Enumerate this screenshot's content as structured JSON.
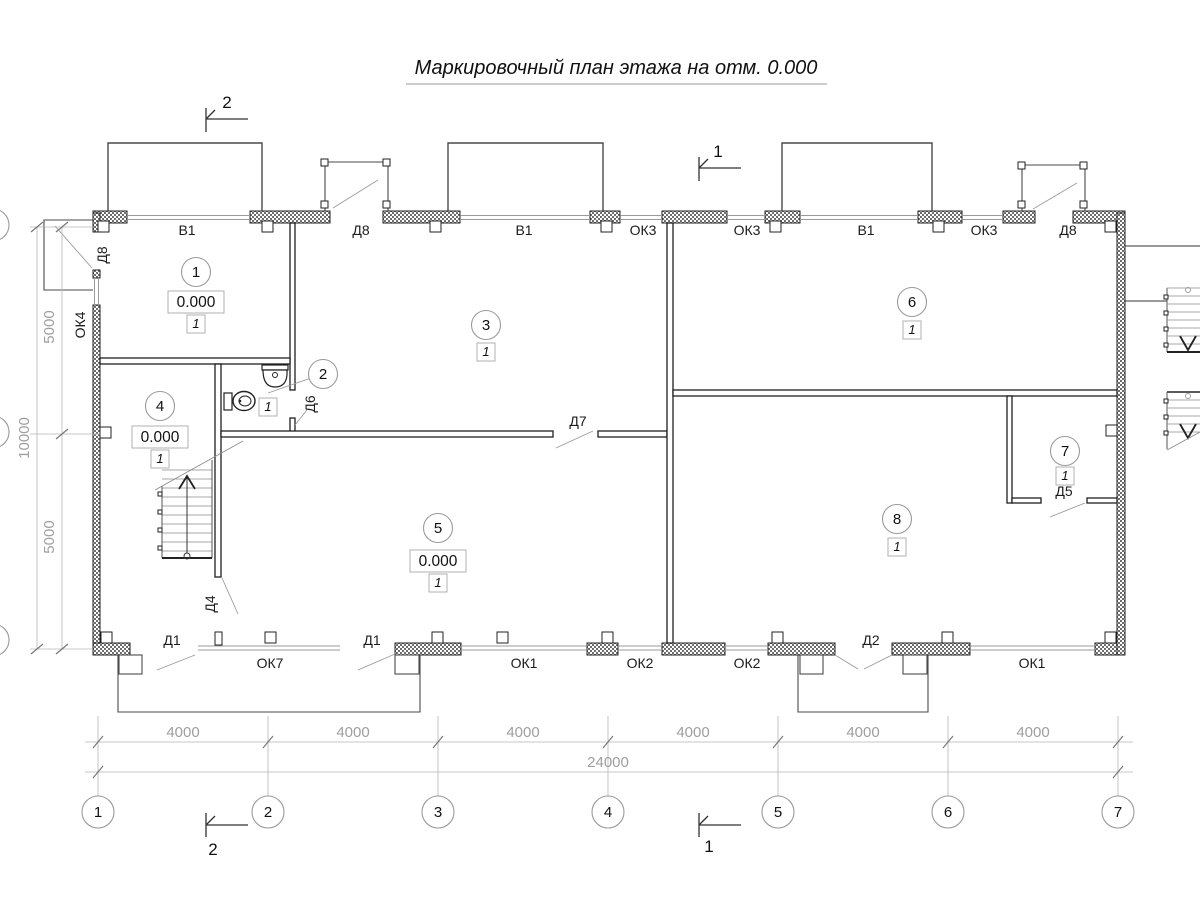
{
  "title": "Маркировочный план этажа на отм. 0.000",
  "section_marks": {
    "top_left": "2",
    "top_center": "1",
    "bottom_left": "2",
    "bottom_center": "1"
  },
  "rooms": [
    {
      "num": "1",
      "elevation": "0.000",
      "floor": "1"
    },
    {
      "num": "2",
      "floor": "1"
    },
    {
      "num": "3",
      "floor": "1"
    },
    {
      "num": "4",
      "elevation": "0.000",
      "floor": "1"
    },
    {
      "num": "5",
      "elevation": "0.000",
      "floor": "1"
    },
    {
      "num": "6",
      "floor": "1"
    },
    {
      "num": "7",
      "floor": "1"
    },
    {
      "num": "8",
      "floor": "1"
    }
  ],
  "openings": {
    "top": [
      "В1",
      "Д8",
      "В1",
      "ОК3",
      "ОК3",
      "В1",
      "ОК3",
      "Д8"
    ],
    "left": [
      "Д8",
      "ОК4"
    ],
    "interior": [
      "Д6",
      "Д7",
      "Д5",
      "Д4"
    ],
    "bottom": [
      "Д1",
      "ОК7",
      "Д1",
      "ОК1",
      "ОК2",
      "ОК2",
      "Д2",
      "ОК1"
    ]
  },
  "dimensions": {
    "bottom_segments": [
      "4000",
      "4000",
      "4000",
      "4000",
      "4000",
      "4000"
    ],
    "bottom_total": "24000",
    "left_segments": [
      "5000",
      "5000"
    ],
    "left_total": "10000"
  },
  "axes": [
    "1",
    "2",
    "3",
    "4",
    "5",
    "6",
    "7"
  ]
}
